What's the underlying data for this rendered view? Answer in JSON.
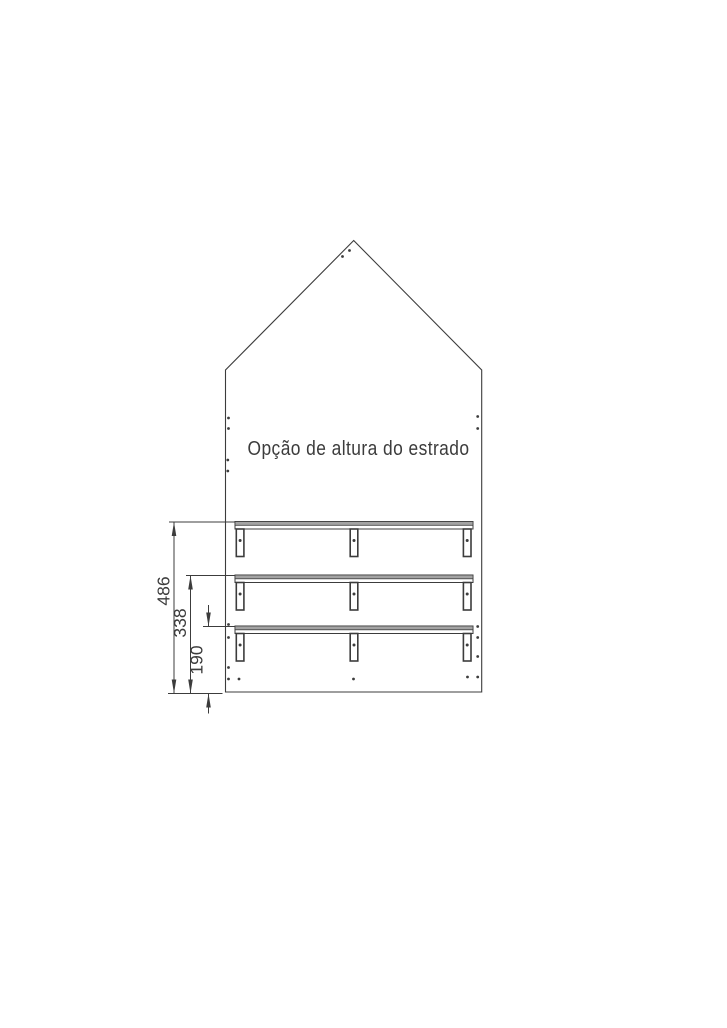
{
  "drawing": {
    "title": "Opção de altura do estrado",
    "rail_count": 3,
    "dimensions": [
      {
        "label": "486"
      },
      {
        "label": "338"
      },
      {
        "label": "190"
      }
    ],
    "colors": {
      "line": "#3c3c3c",
      "rail_band_fill": "#a3a3a3",
      "background": "#ffffff"
    }
  }
}
